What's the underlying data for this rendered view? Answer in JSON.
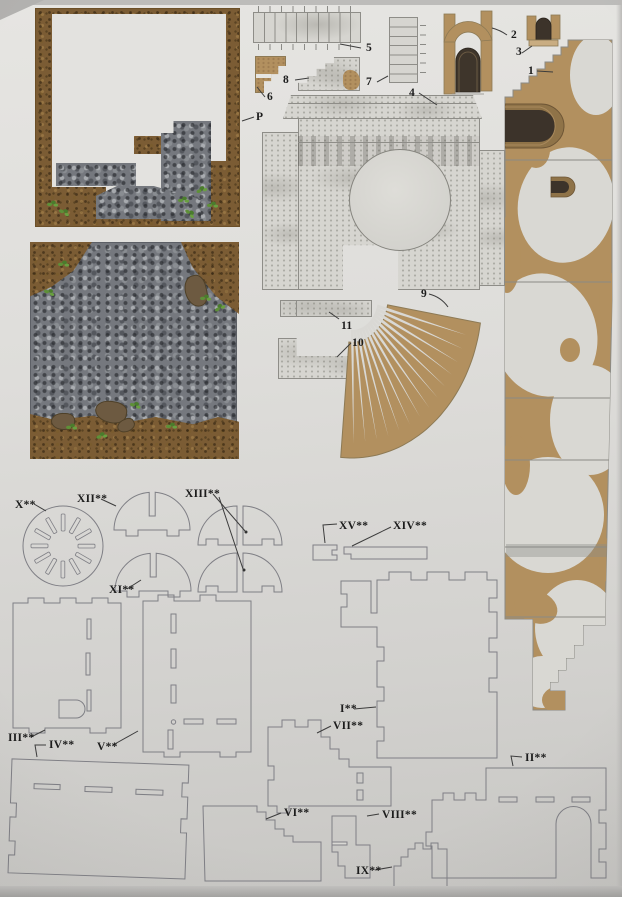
{
  "sheet": {
    "labels": {
      "p": "P",
      "n1": "1",
      "n2": "2",
      "n3": "3",
      "n4": "4",
      "n5": "5",
      "n6": "6",
      "n7": "7",
      "n8": "8",
      "n9": "9",
      "n10": "10",
      "n11": "11",
      "r1": "I**",
      "r2": "II**",
      "r3": "III**",
      "r4": "IV**",
      "r5": "V**",
      "r6": "VI**",
      "r7": "VII**",
      "r8": "VIII**",
      "r9": "IX**",
      "r10": "X**",
      "r11": "XI**",
      "r12": "XII**",
      "r13": "XIII**",
      "r14": "XIV**",
      "r15": "XV**"
    }
  },
  "palette": {
    "paper": "#d9d8d4",
    "kraft_tan": "#b2905f",
    "kraft_edge": "#8d7a55",
    "plaster": "#d9d8d3",
    "dirt_brown": "#7b5c34",
    "gravel_gray": "#75787e",
    "grass_green": "#5e9038",
    "door_dark": "#3c332a",
    "door_frame": "#8f7348",
    "outline_gray": "#7f7f85",
    "label_ink": "#1c1c1c"
  }
}
